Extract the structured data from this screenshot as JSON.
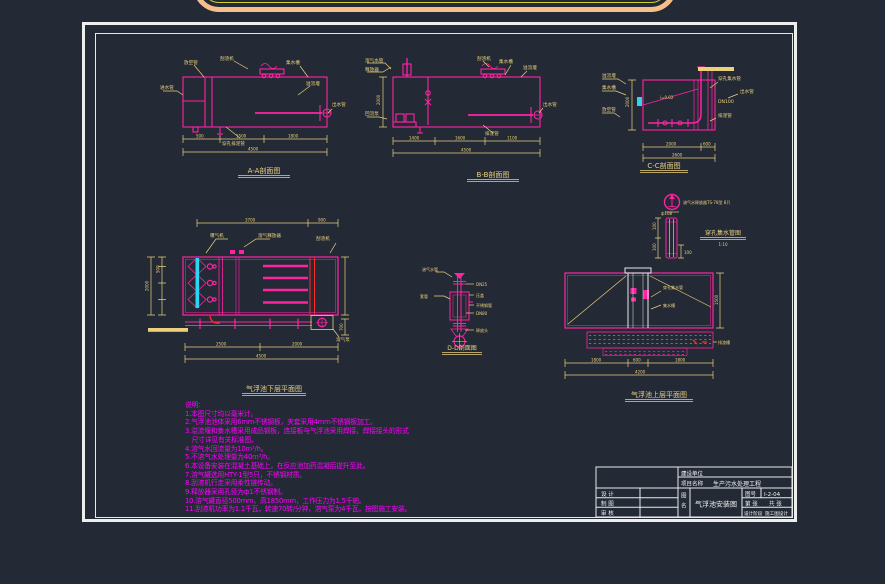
{
  "drawings": {
    "section_aa": {
      "caption": "A-A剖面图",
      "labels": [
        "进水管",
        "放空管",
        "刮渣机",
        "集水槽",
        "溢流堰",
        "出水管",
        "穿孔排泥管"
      ],
      "dims": [
        "500",
        "1500",
        "1800",
        "4500"
      ]
    },
    "section_bb": {
      "caption": "B-B剖面图",
      "labels": [
        "溶气水管",
        "释放器",
        "回流泵",
        "刮渣机",
        "集水槽",
        "溢流堰",
        "出水管",
        "排泥管"
      ],
      "dims": [
        "1400",
        "1600",
        "1100",
        "4500",
        "2000"
      ]
    },
    "section_cc": {
      "caption": "C-C剖面图",
      "labels": [
        "溢流堰",
        "集水槽",
        "放空管",
        "i=0.02",
        "穿孔集水管",
        "出水管",
        "DN100",
        "排泥管"
      ],
      "dims": [
        "2000",
        "600",
        "2600",
        "2000"
      ]
    },
    "lower_plan": {
      "caption": "气浮池下层平面图",
      "labels": [
        "曝气机",
        "溶气释放器",
        "刮渣机",
        "溶气泵"
      ],
      "dims": [
        "3700",
        "900",
        "500",
        "2000",
        "2500",
        "2000",
        "4500",
        "700"
      ]
    },
    "section_dd": {
      "caption": "D-D剖面图",
      "labels": [
        "溶气水管",
        "套管",
        "DN25",
        "压盖",
        "不锈钢管",
        "DN80",
        "释放头"
      ]
    },
    "upper_plan": {
      "caption": "气浮池上层平面图",
      "sub_caption": "穿孔集水管图",
      "sub_scale": "1:10",
      "north_label": "溶气水释放器TS-78型 8只",
      "tube_dims": [
        "100",
        "100",
        "100",
        "ф108"
      ],
      "labels": [
        "穿孔集水管",
        "集水槽",
        "排渣槽"
      ],
      "dims": [
        "1800",
        "600",
        "1800",
        "4200",
        "1500"
      ]
    }
  },
  "notes": {
    "title": "说明:",
    "lines": [
      "1.本图尺寸均以毫米计。",
      "2.气浮池池体采用6mm不锈钢板，夹套采用4mm不锈钢板加工。",
      "3.溢流堰和集水槽采用成品钢板，连接板与气浮池采用焊接，焊接接头的形式",
      "　尺寸详见有关标准图。",
      "4.溶气水回流量为10m³/h。",
      "5.不溶气水处理量为40m³/h。",
      "6.本设备安装在混凝土基础上，在反应池加药混凝后提升至此。",
      "7.溶气罐选用HTY-1型5只，不锈钢材质。",
      "8.刮渣机行走采用柔性链传动。",
      "9.释放器采用孔径为ф1不锈钢制。",
      "10.溶气罐直径500mm，高1850mm，工作压力为1.5千帕。",
      "11.刮渣机功率为1.1千瓦，转速70转/分钟，溶气泵为4千瓦，按图施工安装。"
    ]
  },
  "title_block": {
    "owner_label": "建设单位",
    "project_label": "项目名称",
    "project_name": "生产污水处理工程",
    "design_label": "设  计",
    "draft_label": "制  图",
    "review_label": "审  核",
    "name_label_1": "图",
    "name_label_2": "名",
    "drawing_name": "气浮池安装图",
    "number_label": "图号",
    "number": "I-2-04",
    "sheet_no_label": "第    张",
    "sheet_total_label": "共    张",
    "stage_label": "设计阶段",
    "stage": "施工图设计"
  }
}
